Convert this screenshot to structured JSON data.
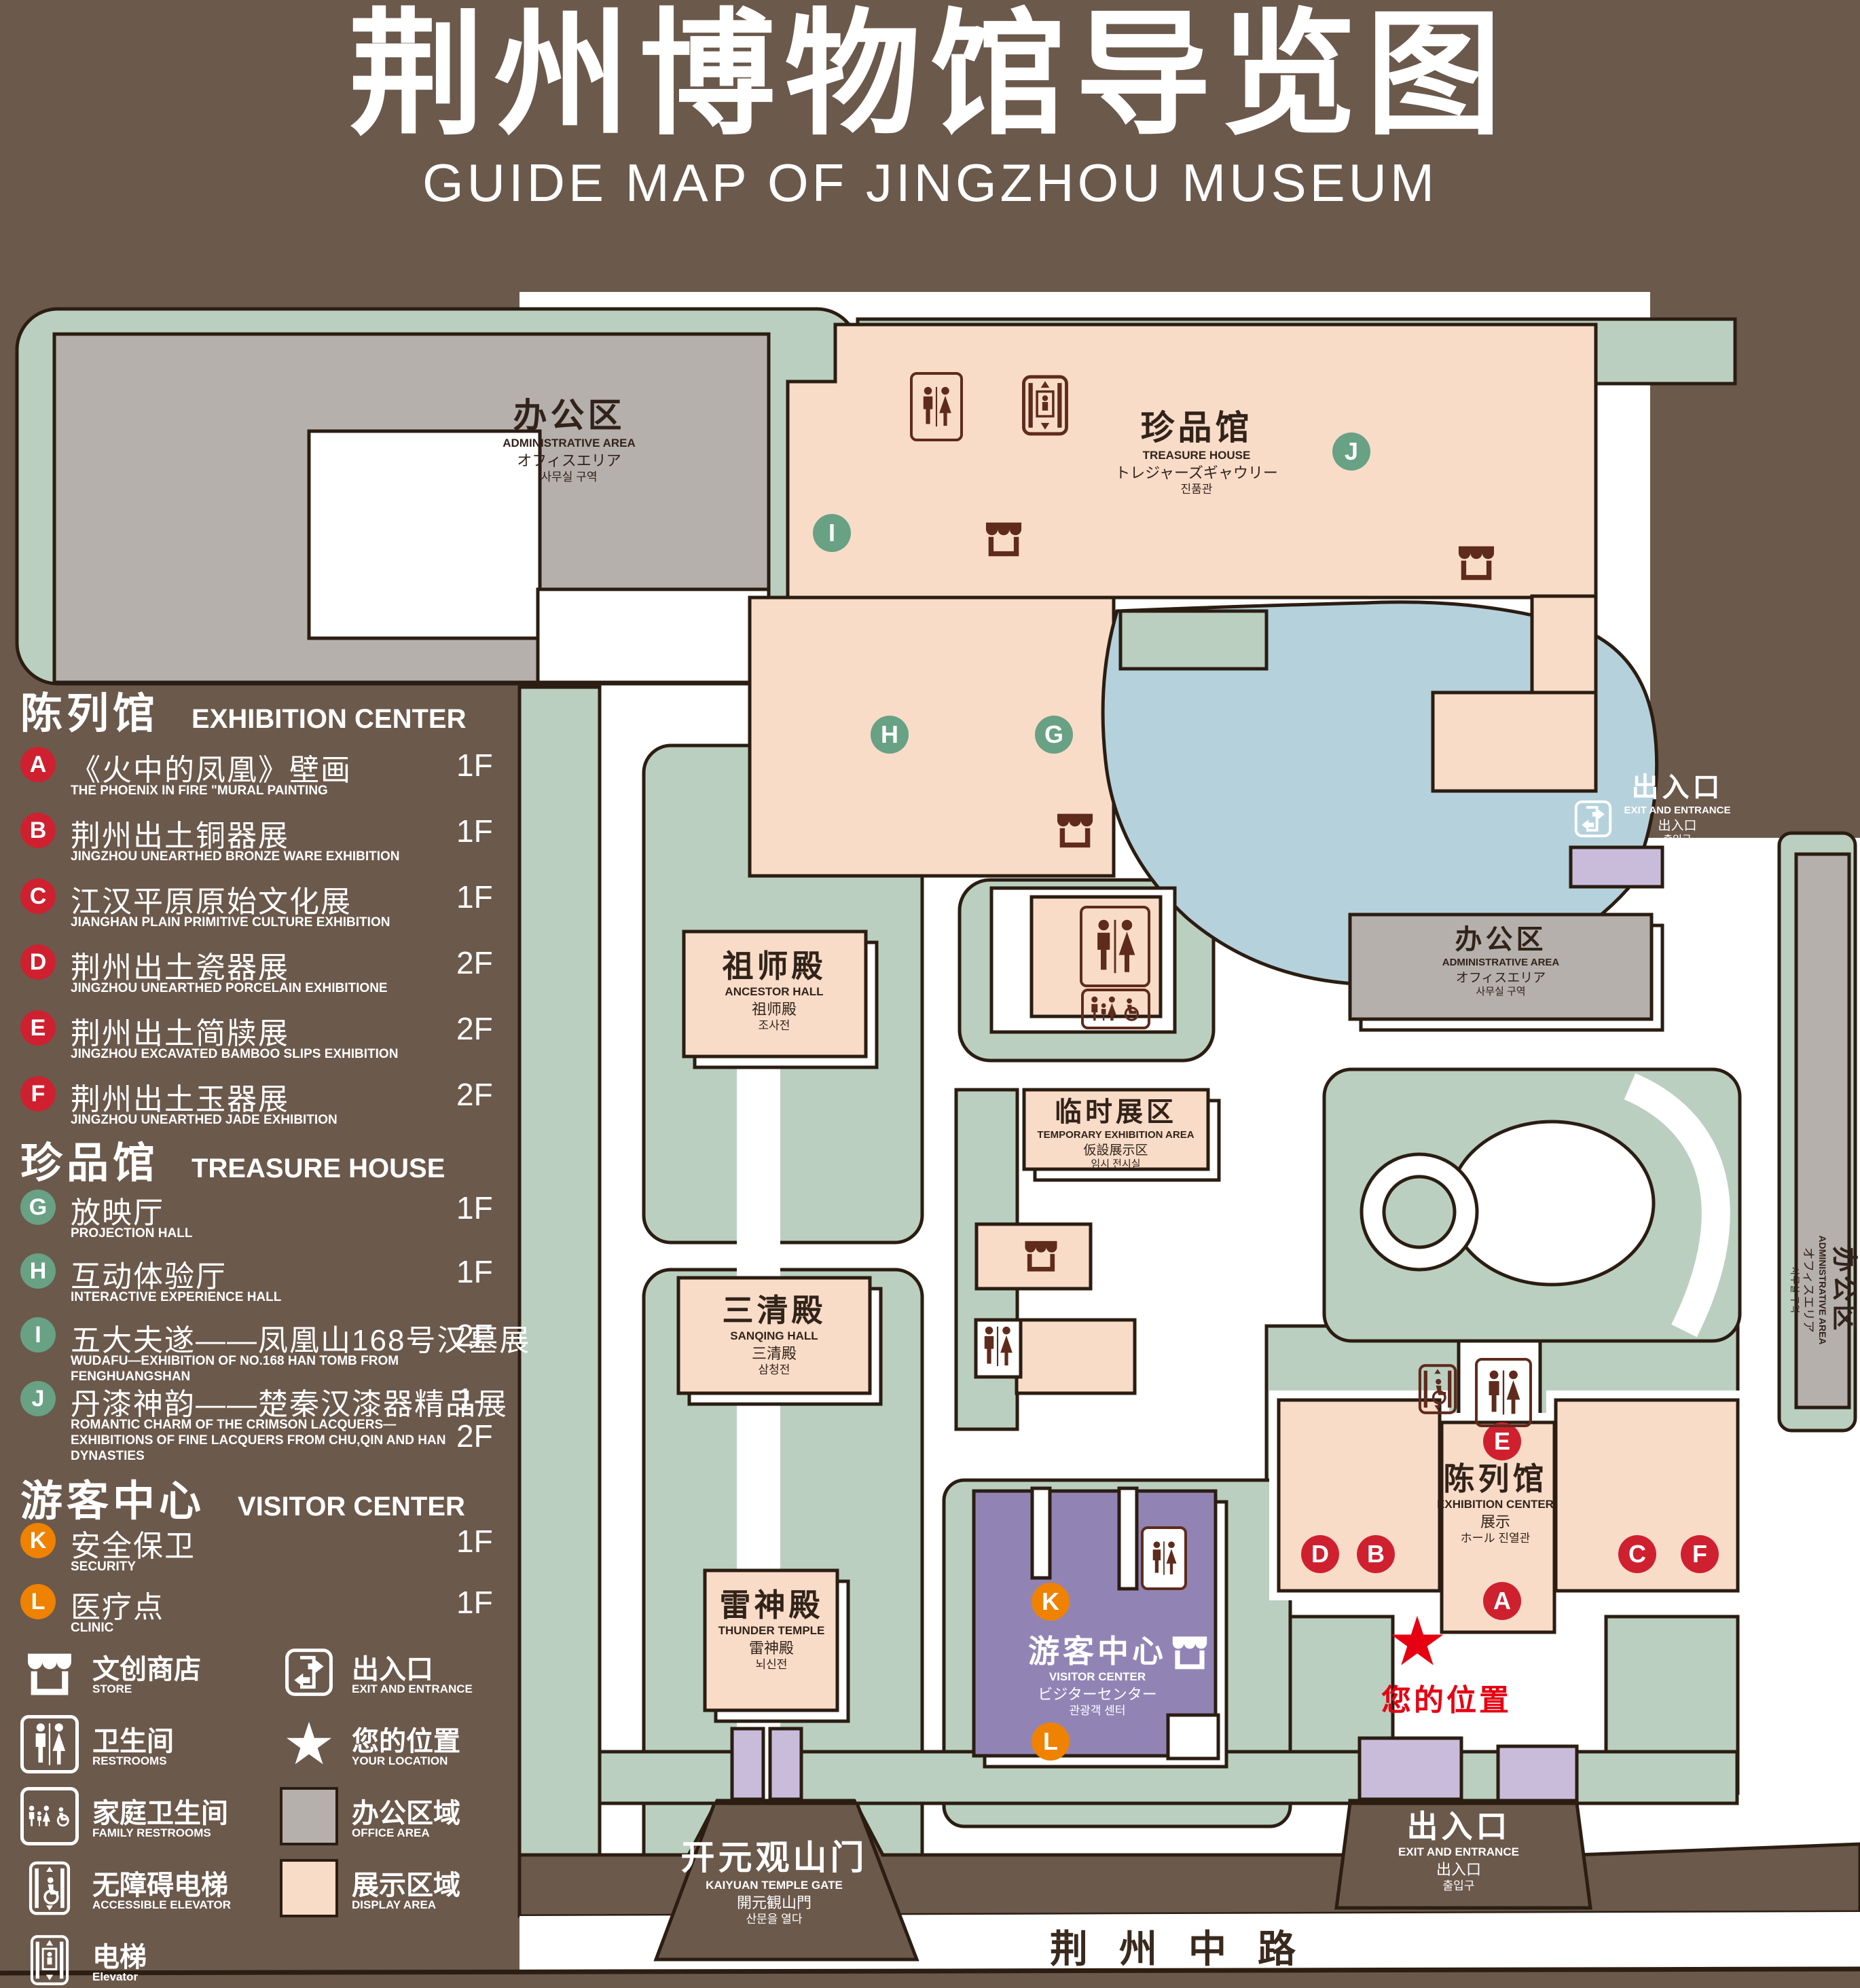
{
  "header": {
    "title_zh": "荆州博物馆导览图",
    "title_en": "GUIDE MAP OF JINGZHOU MUSEUM"
  },
  "legend": {
    "sections": [
      {
        "zh": "陈列馆",
        "en": "EXHIBITION CENTER",
        "items": [
          {
            "key": "A",
            "zh": "《火中的凤凰》壁画",
            "en": "THE PHOENIX IN FIRE \"MURAL PAINTING",
            "floor": "1F"
          },
          {
            "key": "B",
            "zh": "荆州出土铜器展",
            "en": "JINGZHOU UNEARTHED BRONZE WARE EXHIBITION",
            "floor": "1F"
          },
          {
            "key": "C",
            "zh": "江汉平原原始文化展",
            "en": "JIANGHAN PLAIN PRIMITIVE CULTURE EXHIBITION",
            "floor": "1F"
          },
          {
            "key": "D",
            "zh": "荆州出土瓷器展",
            "en": "JINGZHOU UNEARTHED PORCELAIN EXHIBITIONE",
            "floor": "2F"
          },
          {
            "key": "E",
            "zh": "荆州出土简牍展",
            "en": "JINGZHOU EXCAVATED BAMBOO SLIPS EXHIBITION",
            "floor": "2F"
          },
          {
            "key": "F",
            "zh": "荆州出土玉器展",
            "en": "JINGZHOU UNEARTHED JADE EXHIBITION",
            "floor": "2F"
          }
        ]
      },
      {
        "zh": "珍品馆",
        "en": "TREASURE HOUSE",
        "items": [
          {
            "key": "G",
            "zh": "放映厅",
            "en": "PROJECTION HALL",
            "floor": "1F"
          },
          {
            "key": "H",
            "zh": "互动体验厅",
            "en": "INTERACTIVE EXPERIENCE HALL",
            "floor": "1F"
          },
          {
            "key": "I",
            "zh": "五大夫遂——凤凰山168号汉墓展",
            "en": "WUDAFU—EXHIBITION OF NO.168 HAN TOMB FROM FENGHUANGSHAN",
            "floor": "2F"
          },
          {
            "key": "J",
            "zh": "丹漆神韵——楚秦汉漆器精品展",
            "en": "ROMANTIC CHARM OF THE CRIMSON LACQUERS—EXHIBITIONS OF FINE LACQUERS FROM CHU,QIN AND HAN DYNASTIES",
            "floor": "1-2F"
          }
        ]
      },
      {
        "zh": "游客中心",
        "en": "VISITOR CENTER",
        "items": [
          {
            "key": "K",
            "zh": "安全保卫",
            "en": "SECURITY",
            "floor": "1F"
          },
          {
            "key": "L",
            "zh": "医疗点",
            "en": "CLINIC",
            "floor": "1F"
          }
        ]
      }
    ],
    "symbols": {
      "store": {
        "zh": "文创商店",
        "en": "STORE"
      },
      "exit": {
        "zh": "出入口",
        "en": "EXIT AND ENTRANCE"
      },
      "restroom": {
        "zh": "卫生间",
        "en": "RESTROOMS"
      },
      "location": {
        "zh": "您的位置",
        "en": "YOUR LOCATION"
      },
      "family_restroom": {
        "zh": "家庭卫生间",
        "en": "FAMILY RESTROOMS"
      },
      "office_area": {
        "zh": "办公区域",
        "en": "OFFICE AREA"
      },
      "accessible_elevator": {
        "zh": "无障碍电梯",
        "en": "ACCESSIBLE ELEVATOR"
      },
      "display_area": {
        "zh": "展示区域",
        "en": "DISPLAY AREA"
      },
      "elevator": {
        "zh": "电梯",
        "en": "Elevator"
      }
    }
  },
  "map": {
    "admin_nw": {
      "lines": [
        "办公区",
        "ADMINISTRATIVE AREA",
        "オフィスエリア",
        "사무실 구역"
      ]
    },
    "treasure_house": {
      "lines": [
        "珍品馆",
        "TREASURE HOUSE",
        "トレジャーズギャウリー",
        "진품관"
      ],
      "badges": [
        "I",
        "J",
        "H",
        "G"
      ]
    },
    "ancestor_hall": {
      "lines": [
        "祖师殿",
        "ANCESTOR HALL",
        "祖师殿",
        "조사전"
      ]
    },
    "sanqing_hall": {
      "lines": [
        "三清殿",
        "SANQING HALL",
        "三清殿",
        "삼청전"
      ]
    },
    "thunder_temple": {
      "lines": [
        "雷神殿",
        "THUNDER TEMPLE",
        "雷神殿",
        "뇌신전"
      ]
    },
    "temporary_exhibition": {
      "lines": [
        "临时展区",
        "TEMPORARY EXHIBITION AREA",
        "仮設展示区",
        "임시 전시실"
      ]
    },
    "admin_central": {
      "lines": [
        "办公区",
        "ADMINISTRATIVE AREA",
        "オフィスエリア",
        "사무실 구역"
      ]
    },
    "admin_east": {
      "lines": [
        "办公区",
        "ADMINISTRATIVE AREA",
        "オフィスエリア",
        "사무실 구역"
      ]
    },
    "exhibition_center": {
      "lines": [
        "陈列馆",
        "EXHIBITION CENTER",
        "展示",
        "ホール 진열관"
      ],
      "badges": [
        "E",
        "D",
        "B",
        "A",
        "C",
        "F"
      ]
    },
    "visitor_center": {
      "lines": [
        "游客中心",
        "VISITOR CENTER",
        "ビジターセンター",
        "관광객 센터"
      ],
      "badges": [
        "K",
        "L"
      ]
    },
    "exit_ne": {
      "lines": [
        "出入口",
        "EXIT AND ENTRANCE",
        "出入口",
        "출입구"
      ]
    },
    "exit_south": {
      "lines": [
        "出入口",
        "EXIT AND ENTRANCE",
        "出入口",
        "출입구"
      ]
    },
    "kaiyuan_gate": {
      "lines": [
        "开元观山门",
        "KAIYUAN TEMPLE GATE",
        "開元観山門",
        "산문을 열다"
      ]
    },
    "road": {
      "label": "荆州中路"
    },
    "your_location": {
      "label": "您的位置"
    }
  },
  "colors": {
    "background": "#6b594c",
    "garden": "#bacfc0",
    "display_area": "#f8dcc8",
    "office_area": "#b5b0ac",
    "water": "#b5d1dc",
    "visitor_center": "#9184b5",
    "gate": "#c9bcdb",
    "badge_red": "#cf2030",
    "badge_green": "#68a183",
    "badge_orange": "#ef8200",
    "accent_red": "#e60012",
    "outline": "#2b1d12",
    "icon_maroon": "#5f2b1c"
  }
}
